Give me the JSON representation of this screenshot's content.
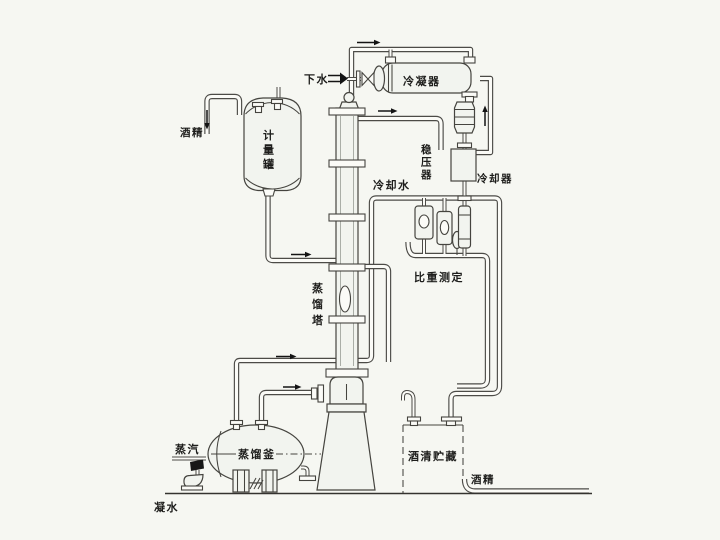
{
  "diagram": {
    "labels": {
      "drain_water": "下水",
      "condenser": "冷凝器",
      "stabilizer": "稳压器",
      "cooling_water": "冷却水",
      "cooler": "冷却器",
      "gravity_measurement": "比重测定",
      "alcohol_in": "酒精",
      "measuring_tank": "计量罐",
      "distillation_column": "蒸馏塔",
      "distillation_kettle": "蒸馏釜",
      "steam": "蒸汽",
      "condensate": "凝水",
      "alcohol_storage": "酒清贮藏",
      "alcohol_out": "酒精"
    },
    "colors": {
      "background": "#f6f7f2",
      "line": "#45443f",
      "pipe_core": "#fbfbf7",
      "text": "#1d1d1b"
    }
  }
}
